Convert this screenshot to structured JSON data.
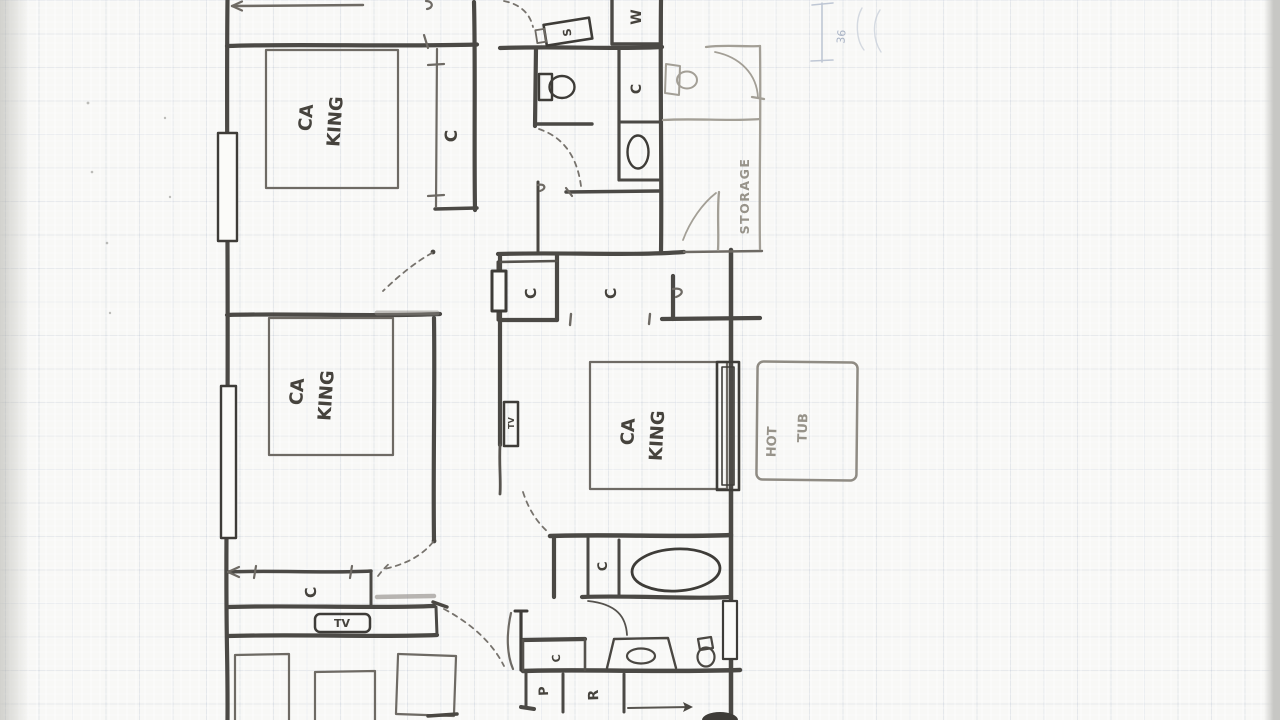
{
  "plan": {
    "bed_label": {
      "line1": "CA",
      "line2": "KING"
    },
    "closet_label": "C",
    "storage_label": "STORAGE",
    "hot_tub_label": {
      "line1": "HOT",
      "line2": "TUB"
    },
    "tv_label": "TV",
    "washer_label": "W",
    "sink_label": "S",
    "pantry_label": "P",
    "fridge_label": "R",
    "dimension_label": "36"
  }
}
